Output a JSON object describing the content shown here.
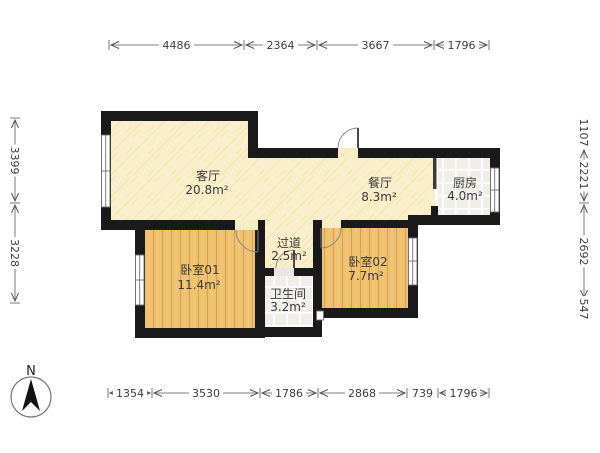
{
  "title": "floor-plan",
  "compass": {
    "north_label": "N"
  },
  "dimensions": {
    "top": [
      "4486",
      "2364",
      "3667",
      "1796"
    ],
    "bottom": [
      "1354",
      "3530",
      "1786",
      "2868",
      "739",
      "1796"
    ],
    "left": [
      "3399",
      "3228"
    ],
    "right": [
      "1107",
      "2221",
      "2692",
      "547"
    ]
  },
  "rooms": {
    "living": {
      "name": "客厅",
      "area": "20.8m²"
    },
    "dining": {
      "name": "餐厅",
      "area": "8.3m²"
    },
    "kitchen": {
      "name": "厨房",
      "area": "4.0m²"
    },
    "hallway": {
      "name": "过道",
      "area": "2.5m²"
    },
    "bedroom01": {
      "name": "卧室01",
      "area": "11.4m²"
    },
    "bathroom": {
      "name": "卫生间",
      "area": "3.2m²"
    },
    "bedroom02": {
      "name": "卧室02",
      "area": "7.7m²"
    }
  },
  "colors": {
    "wall": "#1a1a1a",
    "wood_base": "#eec06f",
    "wood_stripe": "#d9a24e",
    "cream_base": "#f9efcc",
    "tile_base": "#efeee9",
    "dim_line": "#555555"
  }
}
